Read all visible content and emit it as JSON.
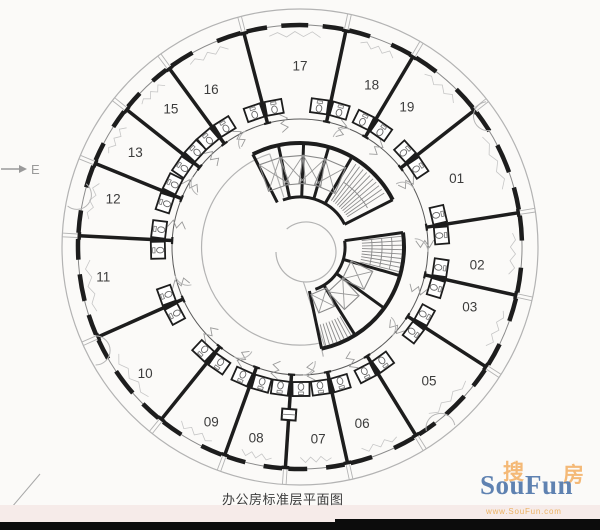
{
  "plan": {
    "caption": "办公房标准层平面图",
    "direction_label": "E",
    "room_labels": [
      "02",
      "03",
      "05",
      "06",
      "07",
      "08",
      "09",
      "10",
      "11",
      "12",
      "13",
      "15",
      "16",
      "17",
      "18",
      "19",
      "01"
    ],
    "wall_color": "#1d1d1d",
    "detail_color": "#8a8a8a",
    "light_color": "#b3b3b3",
    "label_color": "#3c3c3c"
  },
  "watermark": {
    "cn_left": "搜",
    "cn_right": "房",
    "name": "SouFun",
    "url": "www.SouFun.com",
    "cn_color": "#f4b166",
    "name_color": "#4a72a8",
    "url_color": "#e9a94f"
  },
  "footer": {
    "bar_color": "#0c0c0c",
    "strip_color": "#f6ebe9"
  }
}
